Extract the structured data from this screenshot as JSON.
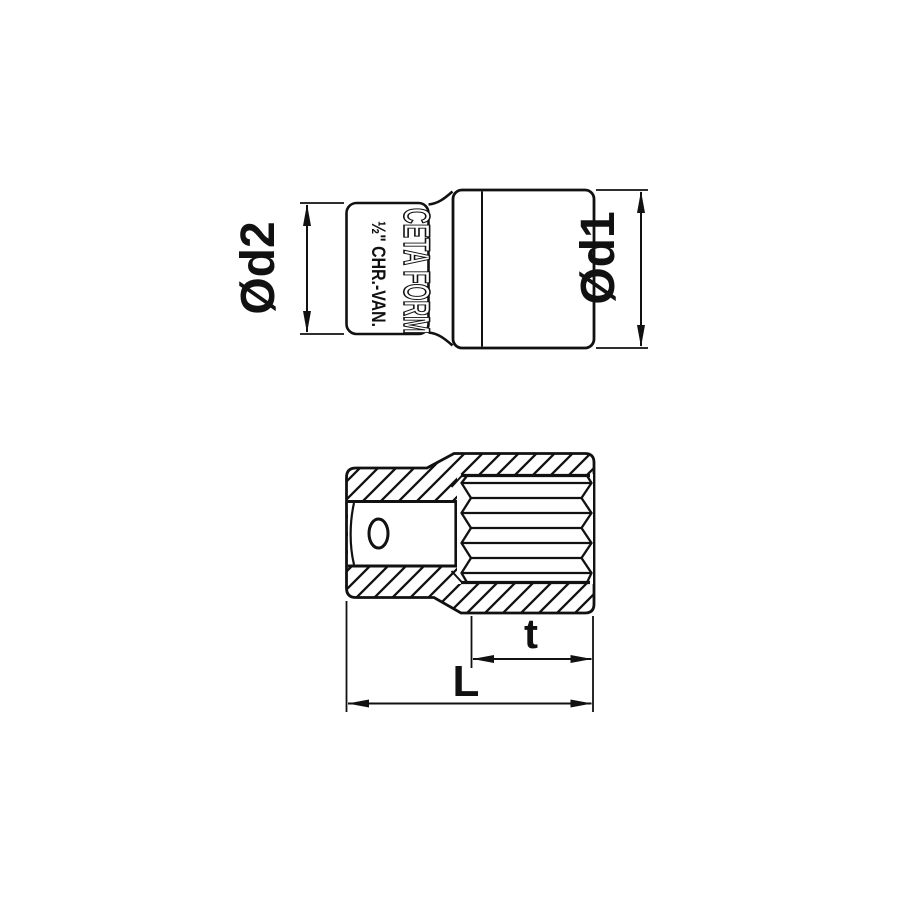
{
  "drawing": {
    "background": "#ffffff",
    "line_color": "#111111",
    "side_view": {
      "brand_marking": "CETA FORM",
      "spec_marking": "½\" CHR.-VAN.",
      "dim_drive_end_diameter": "Ød2",
      "dim_socket_end_diameter": "Ød1"
    },
    "section_view": {
      "dim_broach_depth": "t",
      "dim_overall_length": "L"
    }
  }
}
